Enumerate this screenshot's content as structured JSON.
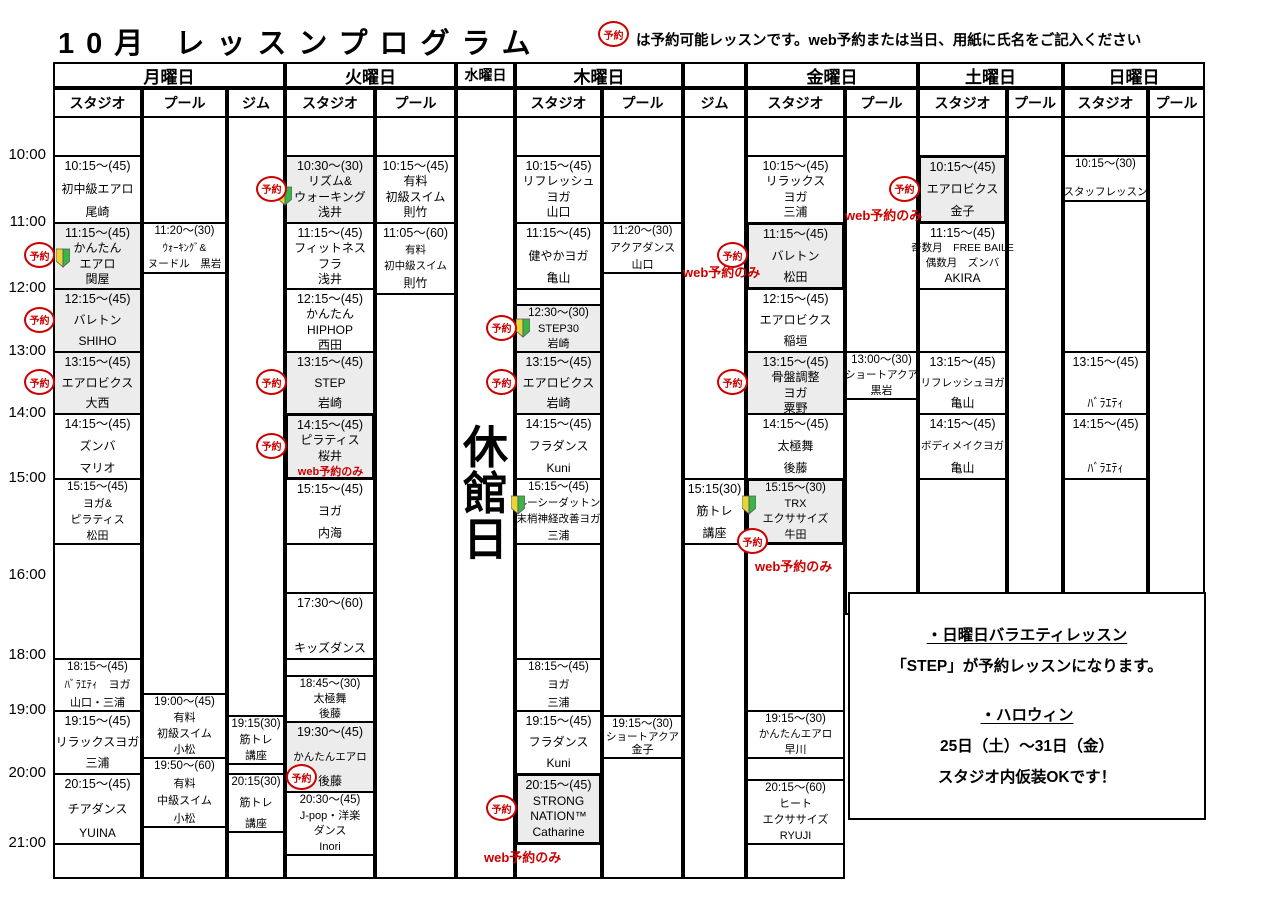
{
  "title": "10月 レッスンプログラム",
  "legend": {
    "badge": "予約",
    "text": "は予約可能レッスンです。web予約または当日、用紙に氏名をご記入ください"
  },
  "reserve_badge_label": "予約",
  "closed_day": {
    "label": "休館日"
  },
  "colors": {
    "accent_red": "#cc0000",
    "cell_shade": "#ececec",
    "beginner_yellow": "#e8d53a",
    "beginner_green": "#3cb44a"
  },
  "time_labels": [
    "10:00",
    "11:00",
    "12:00",
    "13:00",
    "14:00",
    "15:00",
    "16:00",
    "18:00",
    "19:00",
    "20:00",
    "21:00"
  ],
  "web_only_label": "web予約のみ",
  "days": [
    {
      "name": "月曜日",
      "facilities": [
        {
          "type": "スタジオ",
          "lessons": [
            {
              "time": "10:15～(45)",
              "lines": [
                "初中級エアロ"
              ],
              "teacher": "尾崎",
              "cell": [
                "10:00",
                "11:00"
              ]
            },
            {
              "time": "11:15～(45)",
              "lines": [
                "かんたん",
                "エアロ"
              ],
              "teacher": "関屋",
              "cell": [
                "11:00",
                "12:00"
              ],
              "shaded": true,
              "reserve": "out",
              "beginner": "in-low"
            },
            {
              "time": "12:15～(45)",
              "lines": [
                "バレトン"
              ],
              "teacher": "SHIHO",
              "cell": [
                "12:00",
                "13:00"
              ],
              "shaded": true,
              "reserve": "out"
            },
            {
              "time": "13:15～(45)",
              "lines": [
                "エアロビクス"
              ],
              "teacher": "大西",
              "cell": [
                "13:00",
                "14:00"
              ],
              "shaded": true,
              "reserve": "out"
            },
            {
              "time": "14:15～(45)",
              "lines": [
                "ズンバ"
              ],
              "teacher": "マリオ",
              "cell": [
                "14:00",
                "15:00"
              ]
            },
            {
              "time": "15:15～(45)",
              "lines": [
                "ヨガ&",
                "ピラティス"
              ],
              "teacher": "松田",
              "cell": [
                "15:00",
                "16:00"
              ],
              "compact": true
            },
            {
              "time": "18:15～(45)",
              "lines": [
                "ﾊﾞﾗｴﾃｨ　ヨガ"
              ],
              "teacher": "山口・三浦",
              "cell": [
                "18:30",
                "19:00"
              ],
              "compact": true
            },
            {
              "time": "19:15～(45)",
              "lines": [
                "リラックスヨガ"
              ],
              "teacher": "三浦",
              "cell": [
                "19:00",
                "20:00"
              ]
            },
            {
              "time": "20:15～(45)",
              "lines": [
                "チアダンス"
              ],
              "teacher": "YUINA",
              "cell": [
                "20:00",
                "21:00"
              ]
            }
          ]
        },
        {
          "type": "プール",
          "lessons": [
            {
              "time": "11:20～(30)",
              "lines": [
                "ｳｫｰｷﾝｸﾞ&",
                "ヌードル　黒岩"
              ],
              "cell": [
                "11:00",
                "11:45"
              ],
              "small": true,
              "compact": true
            },
            {
              "time": "19:00～(45)",
              "lines": [
                "有料",
                "初級スイム"
              ],
              "teacher": "小松",
              "cell": [
                "18:50",
                "19:45"
              ],
              "compact": true
            },
            {
              "time": "19:50～(60)",
              "lines": [
                "有料",
                "中級スイム"
              ],
              "teacher": "小松",
              "cell": [
                "19:45",
                "20:45"
              ],
              "compact": true
            }
          ]
        },
        {
          "type": "ジム",
          "lessons": [
            {
              "time": "19:15(30)",
              "lines": [
                "筋トレ",
                "講座"
              ],
              "cell": [
                "19:05",
                "19:50"
              ],
              "compact": true
            },
            {
              "time": "20:15(30)",
              "lines": [
                "筋トレ",
                "講座"
              ],
              "cell": [
                "20:00",
                "20:50"
              ],
              "compact": true
            }
          ]
        }
      ]
    },
    {
      "name": "火曜日",
      "facilities": [
        {
          "type": "スタジオ",
          "lessons": [
            {
              "time": "10:30～(30)",
              "lines": [
                "リズム&",
                "ウォーキング"
              ],
              "teacher": "浅井",
              "cell": [
                "10:00",
                "11:00"
              ],
              "shaded": true,
              "reserve": "out",
              "beginner": "left-low"
            },
            {
              "time": "11:15～(45)",
              "lines": [
                "フィットネス",
                "フラ"
              ],
              "teacher": "浅井",
              "cell": [
                "11:00",
                "12:00"
              ]
            },
            {
              "time": "12:15～(45)",
              "lines": [
                "かんたん",
                "HIPHOP"
              ],
              "teacher": "西田",
              "cell": [
                "12:00",
                "13:00"
              ]
            },
            {
              "time": "13:15～(45)",
              "lines": [
                "STEP"
              ],
              "teacher": "岩崎",
              "cell": [
                "13:00",
                "14:00"
              ],
              "shaded": true,
              "reserve": "out"
            },
            {
              "time": "14:15～(45)",
              "lines": [
                "ピラティス"
              ],
              "teacher": "桜井",
              "cell": [
                "14:00",
                "15:00"
              ],
              "shaded": true,
              "thick": true,
              "reserve": "out",
              "web_only": "inline"
            },
            {
              "time": "15:15～(45)",
              "lines": [
                "ヨガ"
              ],
              "teacher": "内海",
              "cell": [
                "15:00",
                "16:00"
              ]
            },
            {
              "time": "17:30～(60)",
              "lines": [
                "キッズダンス"
              ],
              "cell": [
                "17:30",
                "18:30"
              ]
            },
            {
              "time": "18:45～(30)",
              "lines": [
                "太極舞"
              ],
              "teacher": "後藤",
              "cell": [
                "18:40",
                "19:10"
              ],
              "compact": true
            },
            {
              "time": "19:30～(45)",
              "lines": [
                "かんたんエアロ"
              ],
              "teacher": "後藤",
              "cell": [
                "19:10",
                "20:15"
              ],
              "shaded": true,
              "reserve": "in-bottom",
              "small": true
            },
            {
              "time": "20:30～(45)",
              "lines": [
                "J-pop・洋楽",
                "ダンス"
              ],
              "teacher": "Inori",
              "cell": [
                "20:15",
                "21:10"
              ],
              "compact": true
            }
          ]
        },
        {
          "type": "プール",
          "lessons": [
            {
              "time": "10:15～(45)",
              "lines": [
                "有料",
                "初級スイム"
              ],
              "teacher": "則竹",
              "cell": [
                "10:00",
                "11:00"
              ]
            },
            {
              "time": "11:05～(60)",
              "lines": [
                "有料",
                "初中級スイム"
              ],
              "teacher": "則竹",
              "cell": [
                "11:00",
                "12:05"
              ],
              "small": true
            }
          ]
        }
      ]
    },
    {
      "name": "水曜日",
      "closed": true,
      "facilities": []
    },
    {
      "name": "木曜日",
      "facilities": [
        {
          "type": "スタジオ",
          "lessons": [
            {
              "time": "10:15～(45)",
              "lines": [
                "リフレッシュ",
                "ヨガ"
              ],
              "teacher": "山口",
              "cell": [
                "10:00",
                "11:00"
              ]
            },
            {
              "time": "11:15～(45)",
              "lines": [
                "健やかヨガ"
              ],
              "teacher": "亀山",
              "cell": [
                "11:00",
                "12:00"
              ]
            },
            {
              "time": "12:30～(30)",
              "lines": [
                "STEP30"
              ],
              "teacher": "岩崎",
              "cell": [
                "12:15",
                "13:00"
              ],
              "shaded": true,
              "compact": true,
              "reserve": "out",
              "beginner": "in-mid"
            },
            {
              "time": "13:15～(45)",
              "lines": [
                "エアロビクス"
              ],
              "teacher": "岩崎",
              "cell": [
                "13:00",
                "14:00"
              ],
              "shaded": true,
              "reserve": "out"
            },
            {
              "time": "14:15～(45)",
              "lines": [
                "フラダンス"
              ],
              "teacher": "Kuni",
              "cell": [
                "14:00",
                "15:00"
              ]
            },
            {
              "time": "15:15～(45)",
              "lines": [
                "ルーシーダットン",
                "末梢神経改善ヨガ"
              ],
              "teacher": "三浦",
              "cell": [
                "15:00",
                "16:00"
              ],
              "small": true,
              "compact": true,
              "beginner": "in-top"
            },
            {
              "time": "18:15～(45)",
              "lines": [
                "ヨガ"
              ],
              "teacher": "三浦",
              "cell": [
                "18:30",
                "19:00"
              ],
              "compact": true
            },
            {
              "time": "19:15～(45)",
              "lines": [
                "フラダンス"
              ],
              "teacher": "Kuni",
              "cell": [
                "19:00",
                "20:00"
              ]
            },
            {
              "time": "20:15～(45)",
              "lines": [
                "STRONG",
                "NATION™"
              ],
              "teacher": "Catharine",
              "cell": [
                "20:00",
                "21:00"
              ],
              "shaded": true,
              "thick": true,
              "reserve": "out",
              "web_only": "below-left"
            }
          ]
        },
        {
          "type": "プール",
          "lessons": [
            {
              "time": "11:20～(30)",
              "lines": [
                "アクアダンス"
              ],
              "teacher": "山口",
              "cell": [
                "11:00",
                "11:45"
              ],
              "compact": true
            },
            {
              "time": "19:15～(30)",
              "lines": [
                "ショートアクア"
              ],
              "teacher": "金子",
              "cell": [
                "19:05",
                "19:45"
              ],
              "compact": true,
              "small": true
            }
          ]
        },
        {
          "type": "ジム",
          "lessons": [
            {
              "time": "15:15(30)",
              "lines": [
                "筋トレ",
                "講座"
              ],
              "cell": [
                "15:00",
                "16:00"
              ]
            }
          ]
        }
      ]
    },
    {
      "name": "金曜日",
      "facilities": [
        {
          "type": "スタジオ",
          "lessons": [
            {
              "time": "10:15～(45)",
              "lines": [
                "リラックス",
                "ヨガ"
              ],
              "teacher": "三浦",
              "cell": [
                "10:00",
                "11:00"
              ]
            },
            {
              "time": "11:15～(45)",
              "lines": [
                "バレトン"
              ],
              "teacher": "松田",
              "cell": [
                "11:00",
                "12:00"
              ],
              "shaded": true,
              "thick": true,
              "reserve": "out",
              "web_only": "left-low"
            },
            {
              "time": "12:15～(45)",
              "lines": [
                "エアロビクス"
              ],
              "teacher": "稲垣",
              "cell": [
                "12:00",
                "13:00"
              ]
            },
            {
              "time": "13:15～(45)",
              "lines": [
                "骨盤調整",
                "ヨガ"
              ],
              "teacher": "粟野",
              "cell": [
                "13:00",
                "14:00"
              ],
              "shaded": true,
              "reserve": "out"
            },
            {
              "time": "14:15～(45)",
              "lines": [
                "太極舞"
              ],
              "teacher": "後藤",
              "cell": [
                "14:00",
                "15:00"
              ]
            },
            {
              "time": "15:15～(30)",
              "lines": [
                "TRX",
                "エクササイズ"
              ],
              "teacher": "牛田",
              "cell": [
                "15:00",
                "16:00"
              ],
              "shaded": true,
              "thick": true,
              "compact": true,
              "reserve": "corner",
              "beginner": "in-top",
              "web_only": "below"
            },
            {
              "time": "19:15～(30)",
              "lines": [
                "かんたんエアロ"
              ],
              "teacher": "早川",
              "cell": [
                "19:00",
                "19:45"
              ],
              "compact": true,
              "small": true
            },
            {
              "time": "20:15～(60)",
              "lines": [
                "ヒート",
                "エクササイズ"
              ],
              "teacher": "RYUJI",
              "cell": [
                "20:05",
                "21:00"
              ],
              "compact": true
            }
          ]
        },
        {
          "type": "プール",
          "lessons": [
            {
              "time": "13:00～(30)",
              "lines": [
                "ショートアクア"
              ],
              "teacher": "黒岩",
              "cell": [
                "13:00",
                "13:45"
              ],
              "compact": true,
              "small": true
            }
          ]
        }
      ]
    },
    {
      "name": "土曜日",
      "facilities": [
        {
          "type": "スタジオ",
          "lessons": [
            {
              "time": "10:15～(45)",
              "lines": [
                "エアロビクス"
              ],
              "teacher": "金子",
              "cell": [
                "10:00",
                "11:00"
              ],
              "shaded": true,
              "thick": true,
              "reserve": "out",
              "web_only": "left-out"
            },
            {
              "time": "11:15～(45)",
              "lines": [
                "奇数月　FREE BAILE",
                "偶数月　ズンバ"
              ],
              "teacher": "AKIRA",
              "cell": [
                "11:00",
                "12:00"
              ],
              "small": true
            },
            {
              "time": "13:15～(45)",
              "lines": [
                "リフレッシュヨガ"
              ],
              "teacher": "亀山",
              "cell": [
                "13:00",
                "14:00"
              ],
              "small": true
            },
            {
              "time": "14:15～(45)",
              "lines": [
                "ボディメイクヨガ"
              ],
              "teacher": "亀山",
              "cell": [
                "14:00",
                "15:00"
              ],
              "small": true
            }
          ]
        },
        {
          "type": "プール",
          "lessons": []
        }
      ]
    },
    {
      "name": "日曜日",
      "facilities": [
        {
          "type": "スタジオ",
          "lessons": [
            {
              "time": "10:15～(30)",
              "lines": [
                "スタッフレッスン"
              ],
              "cell": [
                "10:00",
                "10:40"
              ],
              "small": true,
              "compact": true
            },
            {
              "time": "13:15～(45)",
              "lines": [
                "ﾊﾞﾗｴﾃｨ"
              ],
              "cell": [
                "13:00",
                "14:00"
              ]
            },
            {
              "time": "14:15～(45)",
              "lines": [
                "ﾊﾞﾗｴﾃｨ"
              ],
              "cell": [
                "14:00",
                "15:00"
              ]
            }
          ]
        },
        {
          "type": "プール",
          "lessons": []
        }
      ]
    }
  ],
  "notice": {
    "lines": [
      {
        "text": "・日曜日バラエティレッスン",
        "underline": true
      },
      {
        "text": "「STEP」が予約レッスンになります。"
      },
      {
        "text": ""
      },
      {
        "text": "・ハロウィン",
        "underline": true
      },
      {
        "text": "25日（土）～31日（金）"
      },
      {
        "text": "スタジオ内仮装OKです！"
      }
    ]
  }
}
